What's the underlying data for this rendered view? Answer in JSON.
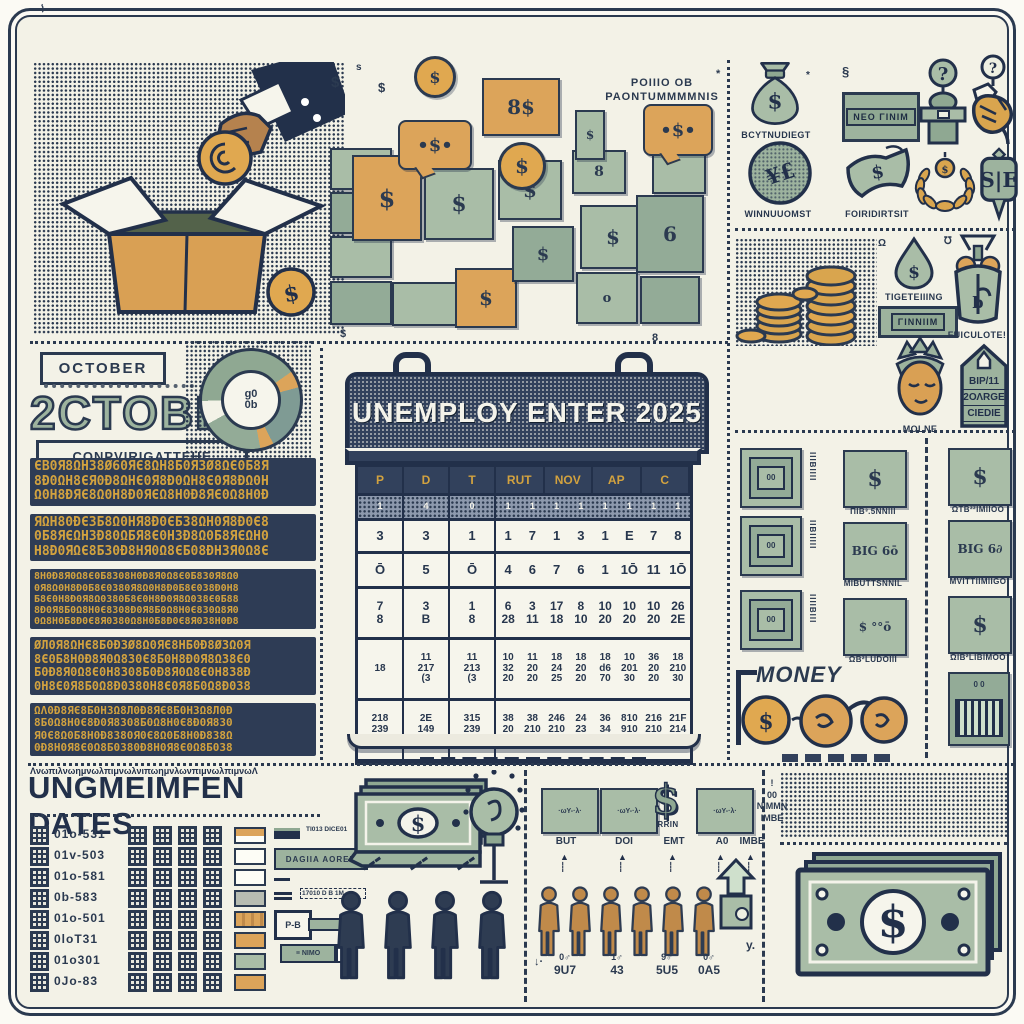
{
  "palette": {
    "paper": "#f3f2e7",
    "navy": "#2b3a50",
    "sage": "#a9bda7",
    "sage_dark": "#8fa892",
    "orange": "#dca45a",
    "gold": "#d2a23f",
    "tan": "#c08a4a"
  },
  "donation": {
    "coin_symbol": "$"
  },
  "wallets": {
    "label_line1": "POIIIO OB",
    "label_line2": "PAONTUMMMMNIS",
    "tiles": [
      {
        "x": 330,
        "y": 148,
        "w": 58,
        "h": 38,
        "c": "green",
        "sym": ""
      },
      {
        "x": 330,
        "y": 192,
        "w": 58,
        "h": 38,
        "c": "greenD",
        "sym": ""
      },
      {
        "x": 330,
        "y": 236,
        "w": 58,
        "h": 38,
        "c": "green",
        "sym": ""
      },
      {
        "x": 330,
        "y": 281,
        "w": 58,
        "h": 40,
        "c": "greenD",
        "sym": ""
      },
      {
        "x": 392,
        "y": 282,
        "w": 64,
        "h": 40,
        "c": "green",
        "sym": ""
      },
      {
        "x": 352,
        "y": 155,
        "w": 66,
        "h": 82,
        "c": "orange",
        "sym": "$",
        "fs": 24
      },
      {
        "x": 424,
        "y": 168,
        "w": 66,
        "h": 68,
        "c": "green",
        "sym": "$",
        "fs": 22
      },
      {
        "x": 455,
        "y": 268,
        "w": 58,
        "h": 56,
        "c": "orange",
        "sym": "$",
        "fs": 20
      },
      {
        "x": 498,
        "y": 160,
        "w": 60,
        "h": 56,
        "c": "green",
        "sym": "$",
        "fs": 20
      },
      {
        "x": 512,
        "y": 226,
        "w": 58,
        "h": 52,
        "c": "greenD",
        "sym": "$",
        "fs": 18
      },
      {
        "x": 572,
        "y": 150,
        "w": 50,
        "h": 40,
        "c": "green",
        "sym": "8",
        "fs": 14
      },
      {
        "x": 580,
        "y": 205,
        "w": 62,
        "h": 60,
        "c": "green",
        "sym": "$",
        "fs": 20
      },
      {
        "x": 636,
        "y": 195,
        "w": 64,
        "h": 74,
        "c": "greenD",
        "sym": "6",
        "fs": 20
      },
      {
        "x": 576,
        "y": 272,
        "w": 58,
        "h": 48,
        "c": "green",
        "sym": "o",
        "fs": 13
      },
      {
        "x": 640,
        "y": 276,
        "w": 56,
        "h": 44,
        "c": "greenD",
        "sym": ""
      },
      {
        "x": 652,
        "y": 148,
        "w": 50,
        "h": 42,
        "c": "green",
        "sym": ""
      },
      {
        "x": 575,
        "y": 110,
        "w": 26,
        "h": 46,
        "c": "green",
        "sym": "$",
        "fs": 12
      }
    ],
    "bubbles": [
      {
        "x": 398,
        "y": 120,
        "w": 70,
        "h": 46,
        "sym": "$",
        "fs": 18
      },
      {
        "x": 643,
        "y": 104,
        "w": 66,
        "h": 48,
        "sym": "$",
        "fs": 18
      }
    ],
    "cards": [
      {
        "x": 482,
        "y": 78,
        "w": 74,
        "h": 54,
        "sym": "8$",
        "fs": 20
      }
    ],
    "coins": [
      {
        "x": 414,
        "y": 56,
        "d": 36,
        "sym": "$",
        "fs": 16
      },
      {
        "x": 498,
        "y": 142,
        "d": 42,
        "sym": "$",
        "fs": 20
      }
    ],
    "marks": [
      {
        "x": 331,
        "y": 74,
        "t": "$",
        "s": 15
      },
      {
        "x": 356,
        "y": 62,
        "t": "s",
        "s": 10
      },
      {
        "x": 378,
        "y": 80,
        "t": "$",
        "s": 13
      },
      {
        "x": 716,
        "y": 68,
        "t": "*",
        "s": 11
      },
      {
        "x": 340,
        "y": 328,
        "t": "$",
        "s": 11
      },
      {
        "x": 652,
        "y": 332,
        "t": "8",
        "s": 11
      },
      {
        "x": 842,
        "y": 64,
        "t": "§",
        "s": 13
      },
      {
        "x": 806,
        "y": 70,
        "t": "*",
        "s": 10
      },
      {
        "x": 878,
        "y": 238,
        "t": "Ω",
        "s": 10
      },
      {
        "x": 944,
        "y": 236,
        "t": "℧",
        "s": 10
      },
      {
        "x": 40,
        "y": 4,
        "t": "⌇",
        "s": 10
      }
    ]
  },
  "icons_top": {
    "items": [
      {
        "type": "moneybag",
        "x": 748,
        "y": 58,
        "w": 54,
        "h": 70,
        "label": "BCYTNUDIEGT",
        "lx": 729,
        "ly": 130,
        "lw": 94
      },
      {
        "type": "plate",
        "x": 842,
        "y": 92,
        "w": 72,
        "h": 44,
        "label": "ΝΕΟ ΓΙΝΙΜ"
      },
      {
        "type": "qpodium",
        "x": 916,
        "y": 58,
        "w": 54,
        "h": 90
      },
      {
        "type": "handshake",
        "x": 968,
        "y": 54,
        "w": 48,
        "h": 96
      },
      {
        "type": "medallion",
        "x": 746,
        "y": 140,
        "w": 68,
        "h": 66,
        "label": "WINNUUOMST",
        "lx": 729,
        "ly": 209,
        "lw": 98
      },
      {
        "type": "flagnote",
        "x": 842,
        "y": 142,
        "w": 70,
        "h": 62,
        "label": "FOIRIDIRTSIT",
        "lx": 831,
        "ly": 209,
        "lw": 92
      },
      {
        "type": "laurel",
        "x": 912,
        "y": 150,
        "w": 66,
        "h": 62
      },
      {
        "type": "shield",
        "x": 980,
        "y": 146,
        "w": 38,
        "h": 76
      }
    ]
  },
  "icons_side": {
    "items": [
      {
        "type": "drop",
        "x": 891,
        "y": 236,
        "w": 46,
        "h": 54,
        "label": "TIGETEIIING",
        "lx": 874,
        "ly": 292,
        "lw": 80
      },
      {
        "type": "plate",
        "x": 878,
        "y": 306,
        "w": 74,
        "h": 26,
        "label": "ΓΙΝΝΙΙΜ"
      },
      {
        "type": "giftbag",
        "x": 948,
        "y": 232,
        "w": 60,
        "h": 96,
        "label": "FUICULOTE!",
        "lx": 936,
        "ly": 330,
        "lw": 82
      },
      {
        "type": "face",
        "x": 891,
        "y": 336,
        "w": 58,
        "h": 86,
        "label": "MOLNE",
        "lx": 891,
        "ly": 424,
        "lw": 58
      },
      {
        "type": "tag",
        "x": 956,
        "y": 342,
        "w": 56,
        "h": 88
      }
    ],
    "tag_lines": [
      "ΒΙΡ/11",
      "2ΟΛRGΕ",
      "CΙΕDΙΕ"
    ]
  },
  "october": {
    "box_top": "OCTOBER",
    "big": "2CTOBER",
    "box_bottom": "CONPVIRIGATTEHE"
  },
  "noise": {
    "bands": [
      {
        "size": 13,
        "rows": [
          "ЄΒ0Я8ΩΗ38Ø60ЯЄ8ΩΗ8Б0Я3Ø8ΩЄ0Б8Я",
          "8Ð0ΩΗ8ЄЯ0Ð8ΩΗЄ0Я8Ð0ΩΗ8Є0Я8ÐΩ0Η",
          "Ω0Η8ÐЯЄ8Ω0Η8Ð0ЯЄΩ8Η0Ð8ЯЄ0Ω8Η0Ð"
        ]
      },
      {
        "size": 13,
        "rows": [
          "ЯΩΗ80ÐЄ3Б8Ω0ΗЯ8Ð0ЄБ38ΩΗ0Я8Ð0Є8",
          "0Б8ЯЄΩΗ3Ð80ΩБЯ8Є0Η3Ð8Ω0Б8ЯЄΩΗ0",
          "Η8Ð0ЯΩЄ8Б30Ð8ΗЯ0Ω8ЄБ08ÐΗ3Я0Ω8Є"
        ]
      },
      {
        "size": 10,
        "rows": [
          "8Η0Ð8Я0Ω8Є0Б8308Η0Ð8Я0Ω8Є0Б830Я8Ω0",
          "0Я8Ω0Η8Ð0Б8Є0380Я8Ω0Η8Ð0Б8Є038Ð0Η8",
          "Б8Є0Η8Ð0Я8Ω0380Б8Є0Η8Ð0Я8Ω038Є0Б88",
          "8Ð0Я8Б0Ω8Η0Є8308Ð0Я8Б0Ω8Η0Є830Ω8Я0",
          "0Ω8Η0Б8Ð0Є8Я0380Ω8Η0Б8Ð0Є8Я038Η0Ð8"
        ]
      },
      {
        "size": 12,
        "rows": [
          "ØЛ0Я8ΩΗЄ8Б0Ð3Ø8Ω0ЯЄ8ΗБ0Ð8Ø3Ω0Я",
          "8Є0Б8Η0Ð8Я0Ω830Є8Б0Η8Ð0Я8Ω38Є0",
          "Б0Ð8Я0Ω8Є0Η8308Б0Ð8Я0Ω8Є0Η838Ð",
          "0Η8Є0Я8Б0Ω8Ð0380Η8Є0Я8Б0Ω8Ð038"
        ]
      },
      {
        "size": 11,
        "rows": [
          "ΩΛ0Ð8ЯЄ8Б0Η3Ω8Л0Ð8ЯЄ8Б0Η3Ω8Л0Ð",
          "8Б0Ω8Η0Є8Ð0Я8308Б0Ω8Η0Є8Ð0Я830",
          "Я0Є8Ω0Б8Η0Ð8380Я0Є8Ω0Б8Η0Ð838Ω",
          "0Ð8Η0Я8Є0Ω8Б0380Ð8Η0Я8Є0Ω8Б038"
        ]
      }
    ],
    "squiggle": "ΛνωπιλνωημνωλπιμνωλνιπωημνλωνπιμνωλπιμνωΛ"
  },
  "calendar": {
    "title": "UNEMPLOY ENTER 2025",
    "headers": [
      "P",
      "D",
      "T",
      "RUT",
      "NOV",
      "AP",
      "C"
    ],
    "mini": {
      "left": [
        "1",
        "4",
        "0"
      ],
      "wide": [
        "1",
        "1",
        "1",
        "1",
        "1",
        "1",
        "1",
        "1"
      ]
    },
    "rows": [
      {
        "h": 30,
        "fs": 13,
        "left": [
          [
            "3"
          ],
          [
            "3"
          ],
          [
            "1"
          ]
        ],
        "wide": [
          [
            "1"
          ],
          [
            "7"
          ],
          [
            "1"
          ],
          [
            "3"
          ],
          [
            "1"
          ],
          [
            "E"
          ],
          [
            "7"
          ],
          [
            "8"
          ]
        ]
      },
      {
        "h": 32,
        "fs": 13,
        "left": [
          [
            "Ō"
          ],
          [
            "5"
          ],
          [
            "Ō"
          ]
        ],
        "wide": [
          [
            "4"
          ],
          [
            "6"
          ],
          [
            "7"
          ],
          [
            "6"
          ],
          [
            "1"
          ],
          [
            "1Ō"
          ],
          [
            "11"
          ],
          [
            "1Ō"
          ]
        ]
      },
      {
        "h": 48,
        "fs": 12,
        "left": [
          [
            "7",
            "8"
          ],
          [
            "3",
            "B"
          ],
          [
            "1",
            "8"
          ]
        ],
        "wide": [
          [
            "6",
            "28"
          ],
          [
            "3",
            "11"
          ],
          [
            "17",
            "18"
          ],
          [
            "8",
            "10"
          ],
          [
            "10",
            "20"
          ],
          [
            "10",
            "20"
          ],
          [
            "10",
            "20"
          ],
          [
            "26",
            "2E"
          ]
        ]
      },
      {
        "h": 58,
        "fs": 10,
        "left": [
          [
            "18"
          ],
          [
            "11",
            "217",
            "(3"
          ],
          [
            "11",
            "213",
            "(3"
          ]
        ],
        "wide": [
          [
            "10",
            "32",
            "20"
          ],
          [
            "11",
            "20",
            "20"
          ],
          [
            "18",
            "24",
            "25"
          ],
          [
            "18",
            "20",
            "20"
          ],
          [
            "18",
            "d6",
            "70"
          ],
          [
            "10",
            "201",
            "30"
          ],
          [
            "36",
            "20",
            "20"
          ],
          [
            "18",
            "210",
            "30"
          ]
        ]
      },
      {
        "h": 58,
        "fs": 10,
        "left": [
          [
            "218",
            "239",
            "D"
          ],
          [
            "2E",
            "149",
            "D"
          ],
          [
            "315",
            "239",
            "D"
          ]
        ],
        "wide": [
          [
            "38",
            "20",
            "20"
          ],
          [
            "38",
            "210",
            "20"
          ],
          [
            "246",
            "210",
            "22"
          ],
          [
            "24",
            "23",
            "23"
          ],
          [
            "36",
            "34",
            "23"
          ],
          [
            "810",
            "910",
            "22"
          ],
          [
            "216",
            "210",
            "22"
          ],
          [
            "21F",
            "214",
            "20"
          ]
        ]
      }
    ]
  },
  "mid_tiles": {
    "col1": {
      "tiles_y": [
        448,
        516,
        590
      ],
      "strips": [
        "ΙΙΙΒΙΙΙΙ",
        "ΙΙΒΙΙΙΙΙ",
        "ΙΙΙΙΒΙΙΙ"
      ]
    },
    "col2": [
      {
        "y": 450,
        "sym": "$",
        "label": "ΠΙΒ³.5ΝΝΙΙΙ"
      },
      {
        "y": 522,
        "sym": "BIG 6ō",
        "label": "ΜΙΒUΤΤSΝΝΙL"
      },
      {
        "y": 598,
        "sym": "$ °°ō",
        "label": "ΩΒ²LUDΟΙΙΙ"
      }
    ],
    "col3": [
      {
        "y": 448,
        "sym": "$",
        "label": "ΩΤΒ²²ΙΜΙΙΟΟ"
      },
      {
        "y": 520,
        "sym": "BIG 6∂",
        "label": "ΜVΙΤΤΙΙΜΙΙGΟ"
      },
      {
        "y": 596,
        "sym": "$",
        "label": "ΩΙΒ²LΙΒΙΜΟΟ"
      }
    ],
    "money_label": "MONEY",
    "glasses_coin": "$"
  },
  "bottom_left": {
    "title": "UNGMEIMFEN DATES",
    "codes": [
      "01o-531",
      "01v-503",
      "01o-581",
      "0b-583",
      "01o-501",
      "0loT31",
      "01o301",
      "0Jo-83"
    ],
    "swatches": [
      "split",
      "white",
      "white",
      "gray",
      "stripe",
      "orange",
      "sage",
      "orange"
    ],
    "legend": {
      "l1": "TI013 DICE01",
      "l2": "DAGIIA AOREN",
      "l4": "17010 D B 1M",
      "key": "P-B",
      "l6": "NIMO"
    }
  },
  "bottom_mid": {
    "labels": [
      "BUT",
      "DOI",
      "EMT",
      "A0",
      "IMBE"
    ],
    "dollar": "$",
    "dollar_label": "RRIN",
    "tile_scribble": "·ωΥ-·λ·",
    "note": [
      "!",
      "00",
      "NIMMN",
      "IMBE"
    ],
    "counts": [
      [
        "0♂",
        "9U7"
      ],
      [
        "1♂",
        "43"
      ],
      [
        "9♂",
        "5U5"
      ],
      [
        "0♂",
        "0A5"
      ]
    ],
    "y_mark": "y."
  },
  "bottom_right": {
    "dollar": "$"
  }
}
